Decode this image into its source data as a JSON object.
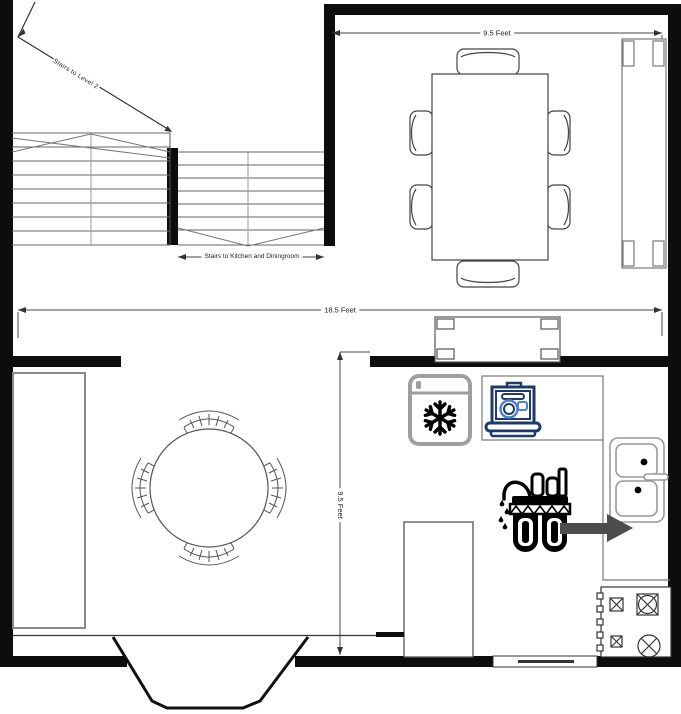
{
  "labels": {
    "dining_width": "9.5 Feet",
    "total_width": "18.5 Feet",
    "kitchen_depth": "9.5 Feet",
    "stairs_up": "Stairs to Level 2",
    "stairs_down": "Stairs to Kitchen and Diningroom"
  },
  "objects": [
    "left-wall",
    "top-wall",
    "right-wall",
    "bottom-wall",
    "interior-wall",
    "stairs-upper-flight",
    "stairs-lower-flight",
    "stairs-direction-arrow",
    "dining-table",
    "dining-chairs-x6",
    "sideboard",
    "console-table",
    "round-table",
    "nook-chairs-x4",
    "left-counter",
    "bay-window",
    "bottom-window",
    "freezer-icon",
    "dishwasher-icon",
    "kitchen-counter",
    "sink",
    "stove",
    "peninsula-counter",
    "water-filter-icon",
    "filter-to-sink-arrow"
  ],
  "colors": {
    "wall": "#0d0d0d",
    "outline": "#555555",
    "counter_outline": "#888888",
    "freezer_gray": "#9e9e9e",
    "dishwasher_navy": "#1e3a6d",
    "dishwasher_blue": "#4f7fd0",
    "arrow_gray": "#4d4d4d",
    "dimension": "#333333"
  }
}
